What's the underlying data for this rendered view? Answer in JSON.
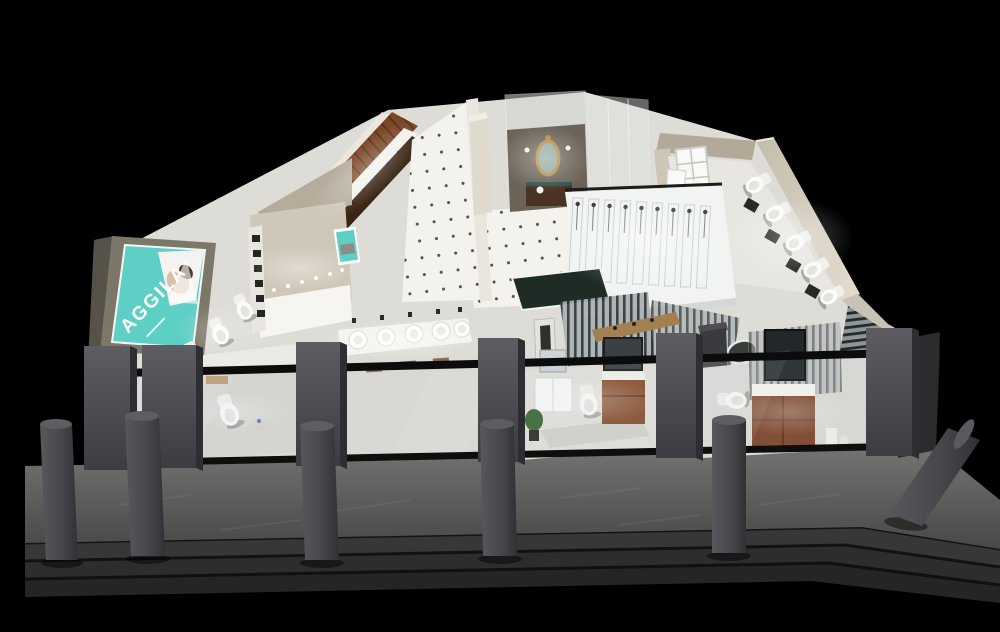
{
  "brand": {
    "name": "AGGILA"
  },
  "palette": {
    "background": "#000000",
    "brand_teal": "#5ecfc5",
    "walkway_gray": "#5c5c5c",
    "step_gray": "#343434",
    "pillar_gray": "#47474a",
    "storefront_frame": "#0c0c0c",
    "wood_brown": "#7c4a28",
    "wall_beige": "#cfc7b6",
    "floor_white": "#eceae5",
    "gold_mirror": "#b9893e"
  }
}
